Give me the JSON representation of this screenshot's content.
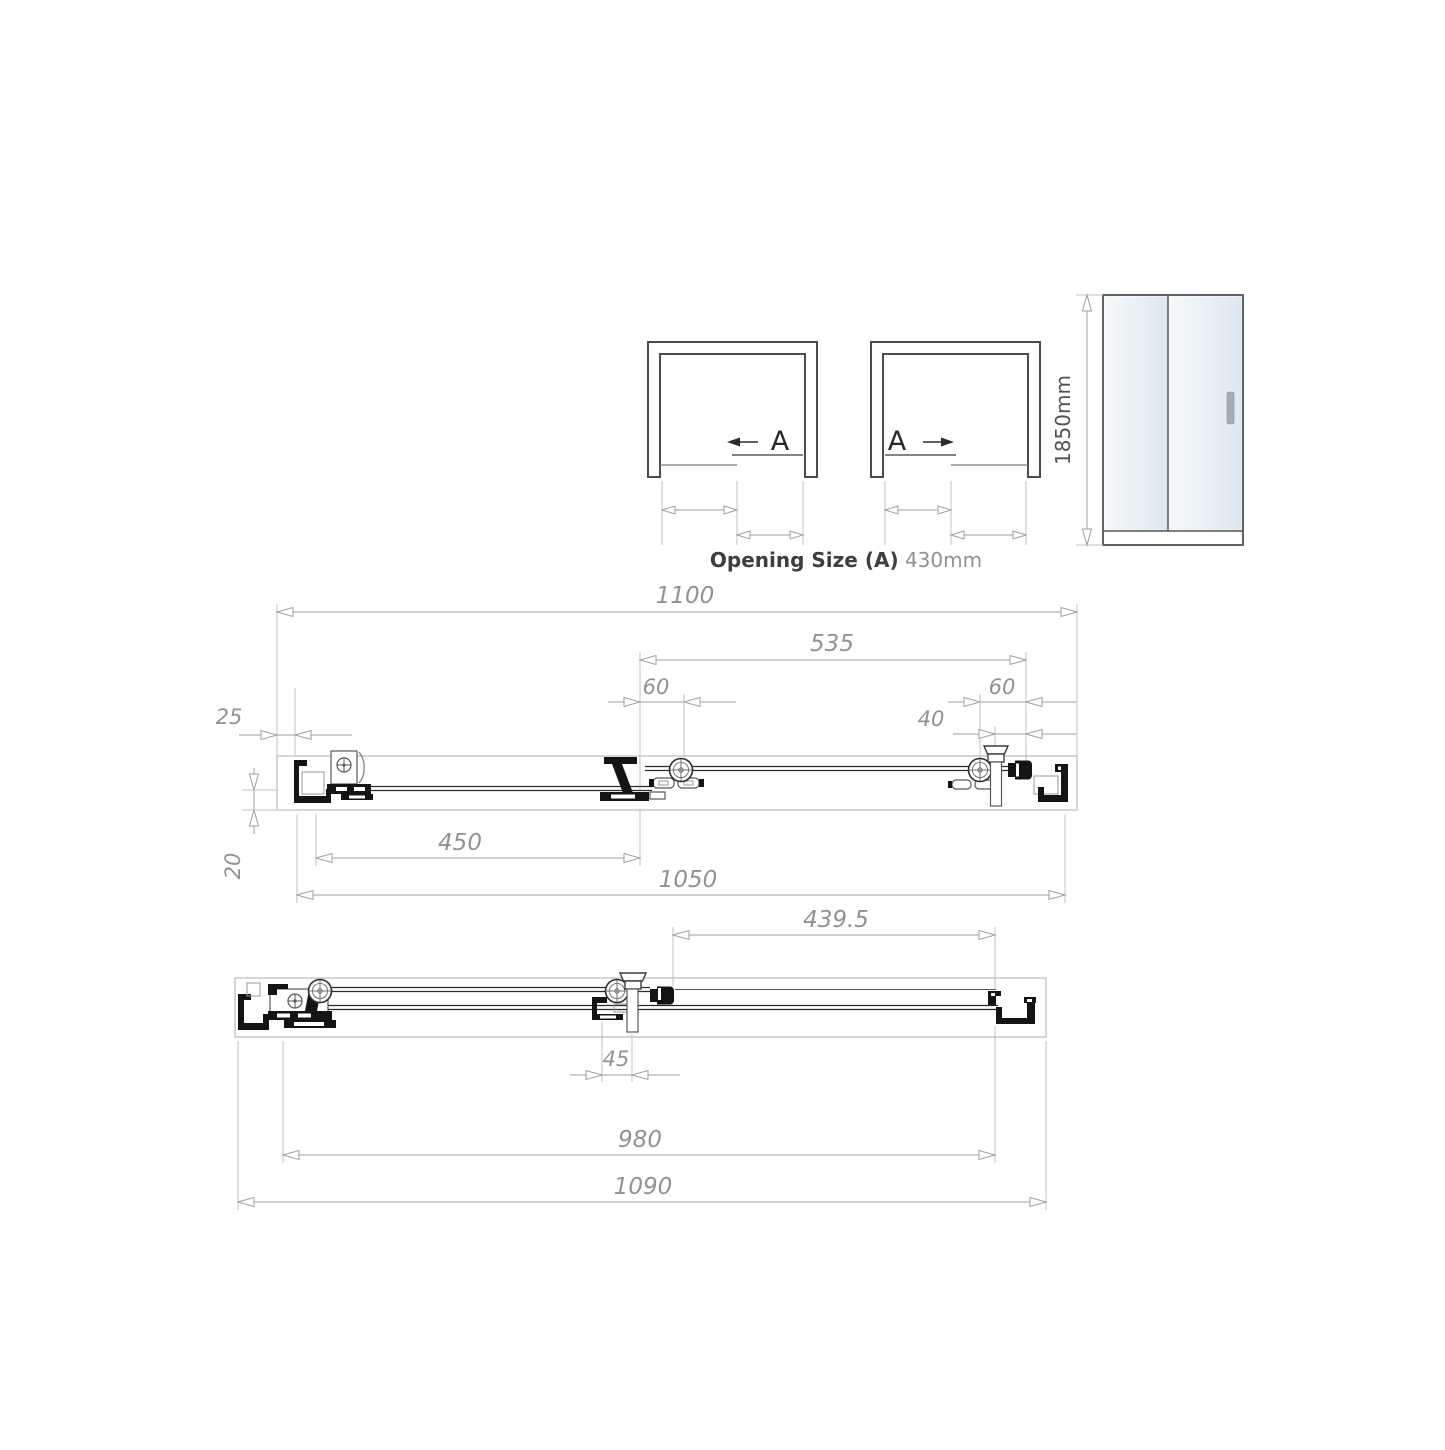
{
  "colors": {
    "dimension_lines": "#9aa0a3",
    "dimension_text": "#8e9396",
    "drawing_dark": "#121416",
    "frame_gray": "#4a4d4f",
    "glass_tint_light": "#f5f9fb",
    "glass_tint_dark": "#dce7ee",
    "handle_gray": "#a6adb3"
  },
  "opening": {
    "left_label": "A",
    "right_label": "A",
    "caption_label": "Opening Size (A)",
    "caption_value": "430mm"
  },
  "front": {
    "height": "1850mm"
  },
  "top_plan": {
    "overall": "1100",
    "panel": "535",
    "roller_left": "60",
    "roller_right": "60",
    "handle": "40",
    "wall_gap": "25",
    "fixed_panel": "450",
    "inner": "1050",
    "depth": "20"
  },
  "bottom_plan": {
    "panel": "439.5",
    "handle_offset": "45",
    "inner": "980",
    "overall": "1090"
  }
}
